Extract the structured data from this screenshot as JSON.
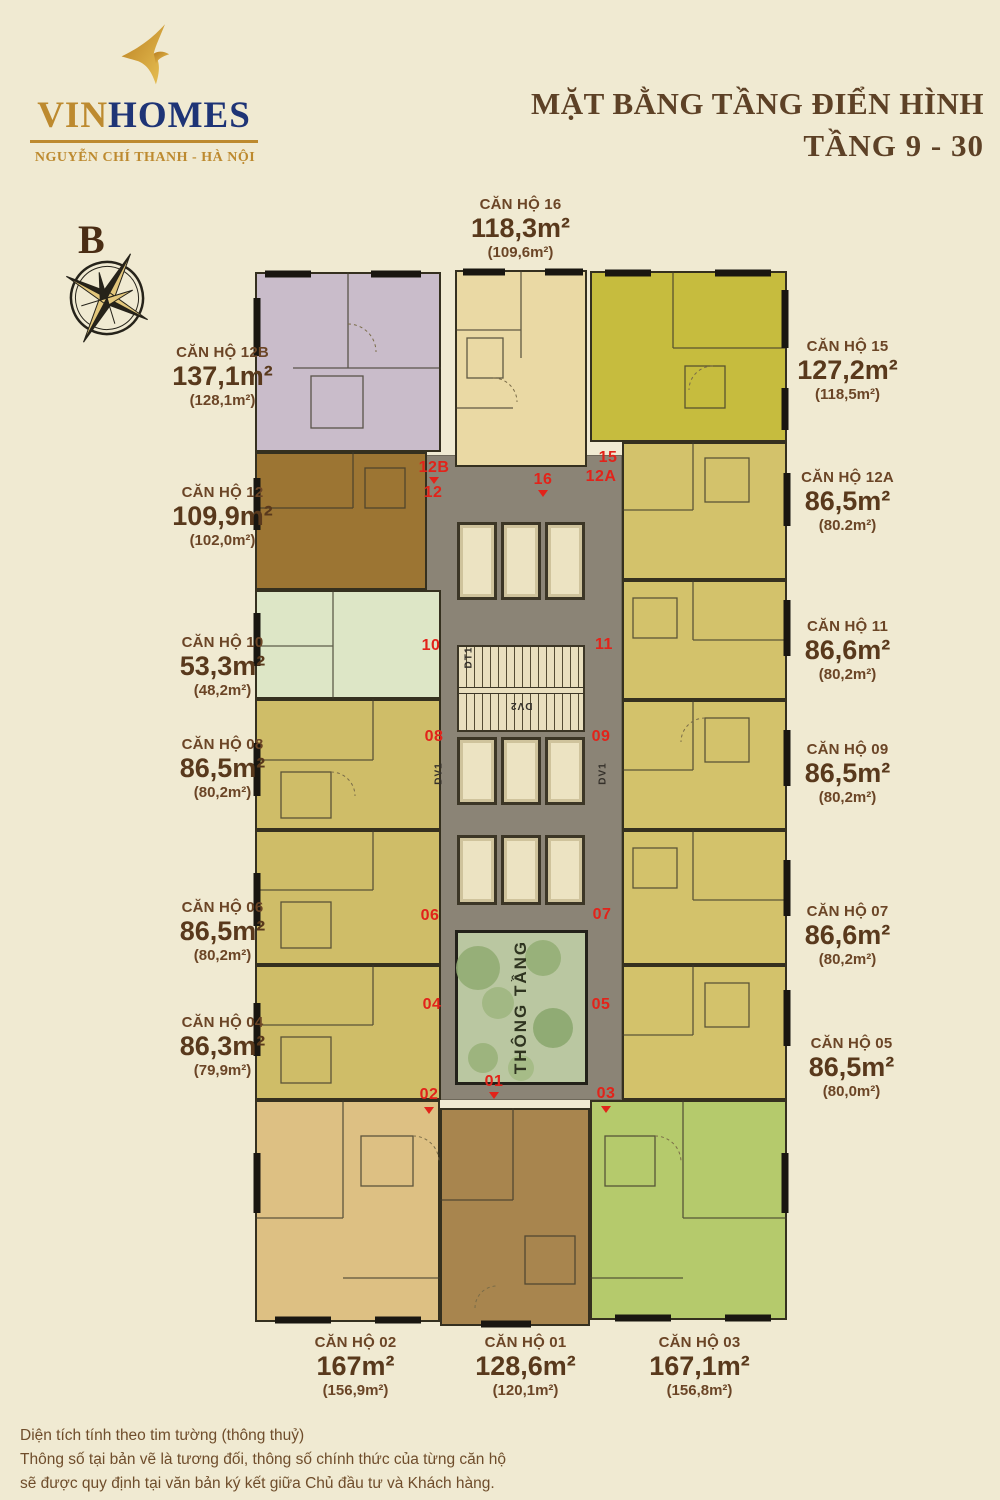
{
  "header": {
    "brand": {
      "vin": "VIN",
      "homes": "HOMES",
      "location": "NGUYỄN CHÍ THANH - HÀ NỘI"
    },
    "title": {
      "line1": "MẶT BẰNG TẦNG ĐIỂN HÌNH",
      "line2": "TẦNG 9 - 30"
    }
  },
  "compass": {
    "north_label": "B"
  },
  "plan": {
    "atrium_label": "THÔNG TẦNG",
    "core_labels": {
      "dv1": "DV1",
      "dv2": "DV2",
      "dt1": "DT1"
    }
  },
  "units": [
    {
      "id": "12B",
      "name": "CĂN HỘ 12B",
      "area": "137,1m²",
      "net_area": "(128,1m²)"
    },
    {
      "id": "16",
      "name": "CĂN HỘ 16",
      "area": "118,3m²",
      "net_area": "(109,6m²)"
    },
    {
      "id": "15",
      "name": "CĂN HỘ 15",
      "area": "127,2m²",
      "net_area": "(118,5m²)"
    },
    {
      "id": "12",
      "name": "CĂN HỘ 12",
      "area": "109,9m²",
      "net_area": "(102,0m²)"
    },
    {
      "id": "12A",
      "name": "CĂN HỘ 12A",
      "area": "86,5m²",
      "net_area": "(80.2m²)"
    },
    {
      "id": "10",
      "name": "CĂN HỘ 10",
      "area": "53,3m²",
      "net_area": "(48,2m²)"
    },
    {
      "id": "11",
      "name": "CĂN HỘ 11",
      "area": "86,6m²",
      "net_area": "(80,2m²)"
    },
    {
      "id": "08",
      "name": "CĂN HỘ 08",
      "area": "86,5m²",
      "net_area": "(80,2m²)"
    },
    {
      "id": "09",
      "name": "CĂN HỘ 09",
      "area": "86,5m²",
      "net_area": "(80,2m²)"
    },
    {
      "id": "06",
      "name": "CĂN HỘ 06",
      "area": "86,5m²",
      "net_area": "(80,2m²)"
    },
    {
      "id": "07",
      "name": "CĂN HỘ 07",
      "area": "86,6m²",
      "net_area": "(80,2m²)"
    },
    {
      "id": "04",
      "name": "CĂN HỘ 04",
      "area": "86,3m²",
      "net_area": "(79,9m²)"
    },
    {
      "id": "05",
      "name": "CĂN HỘ 05",
      "area": "86,5m²",
      "net_area": "(80,0m²)"
    },
    {
      "id": "02",
      "name": "CĂN HỘ 02",
      "area": "167m²",
      "net_area": "(156,9m²)"
    },
    {
      "id": "01",
      "name": "CĂN HỘ 01",
      "area": "128,6m²",
      "net_area": "(120,1m²)"
    },
    {
      "id": "03",
      "name": "CĂN HỘ 03",
      "area": "167,1m²",
      "net_area": "(156,8m²)"
    }
  ],
  "footer": {
    "line1": "Diện tích tính theo tim tường (thông thuỷ)",
    "line2": "Thông số tại bản vẽ là tương đối, thông số chính thức của từng căn hộ",
    "line3": "sẽ được quy định tại văn bản ký kết giữa Chủ đầu tư và Khách hàng."
  },
  "colors": {
    "background": "#f0ead2",
    "accent_red": "#e2231a",
    "brand_gold": "#bd8a2f",
    "brand_navy": "#1e3476",
    "text_brown": "#6b4526",
    "core_gray": "#8b8476",
    "unit_12b": "#c9bcca",
    "unit_16": "#ead9a4",
    "unit_15": "#c6bc3e",
    "unit_12": "#9c7533",
    "unit_10": "#dde6c6",
    "unit_khaki": "#cfbd68",
    "unit_02": "#ddc083",
    "unit_01": "#a8854e",
    "unit_03": "#b5ca6c",
    "atrium_green": "#bac7a1"
  }
}
